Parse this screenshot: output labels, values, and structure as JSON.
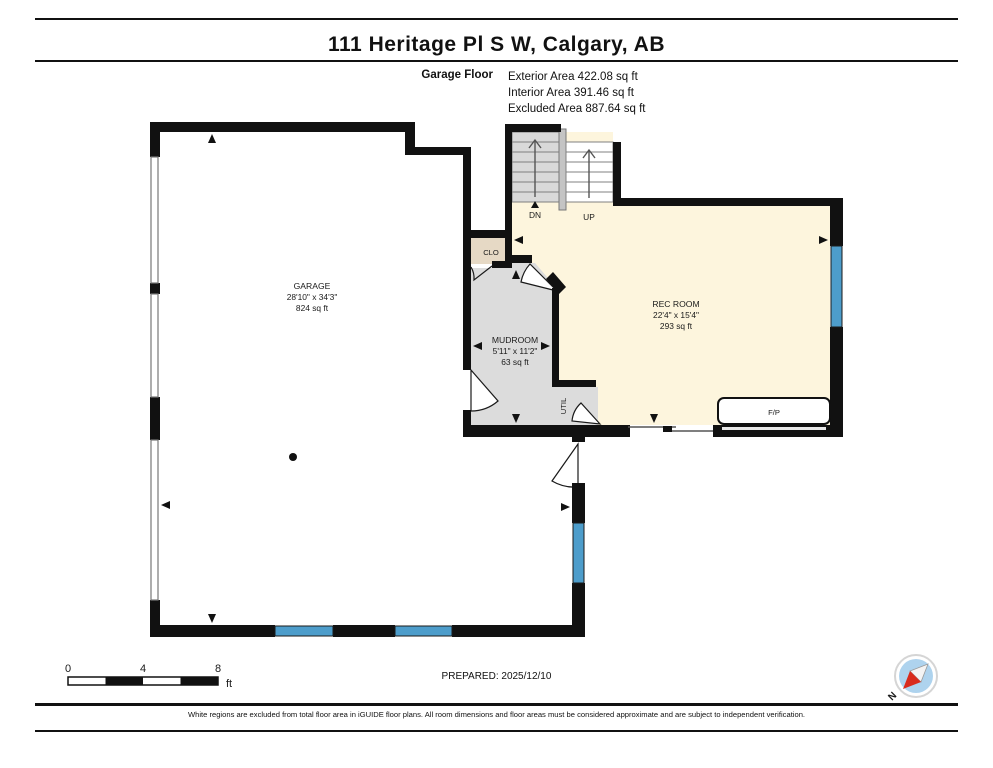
{
  "title": "111 Heritage Pl S W, Calgary, AB",
  "floor_info": {
    "floor_name": "Garage Floor",
    "exterior_area": "Exterior Area 422.08 sq ft",
    "interior_area": "Interior Area 391.46 sq ft",
    "excluded_area": "Excluded Area 887.64 sq ft"
  },
  "rooms": {
    "garage": {
      "name": "GARAGE",
      "dimensions": "28'10\" x 34'3\"",
      "area": "824 sq ft"
    },
    "rec_room": {
      "name": "REC ROOM",
      "dimensions": "22'4\" x 15'4\"",
      "area": "293 sq ft"
    },
    "mudroom": {
      "name": "MUDROOM",
      "dimensions": "5'11\" x 11'2\"",
      "area": "63 sq ft"
    },
    "closet": {
      "name": "CLO"
    },
    "utility": {
      "name": "UTIL"
    },
    "fireplace": {
      "name": "F/P"
    }
  },
  "stairs": {
    "down_label": "DN",
    "up_label": "UP"
  },
  "scale_bar": {
    "tick0": "0",
    "tick1": "4",
    "tick2": "8",
    "unit": "ft"
  },
  "prepared": "PREPARED: 2025/12/10",
  "compass": {
    "label": "N"
  },
  "footer": "White regions are excluded from total floor area in iGUIDE floor plans. All room dimensions and floor areas must be considered approximate and are subject to independent verification.",
  "colors": {
    "wall": "#111111",
    "room_cream": "#fdf5dd",
    "room_gray": "#dcdcdc",
    "room_tan": "#e6d9c5",
    "window_blue": "#4d9dcb",
    "compass_blue": "#aed3ee",
    "compass_red": "#d92b1c"
  }
}
